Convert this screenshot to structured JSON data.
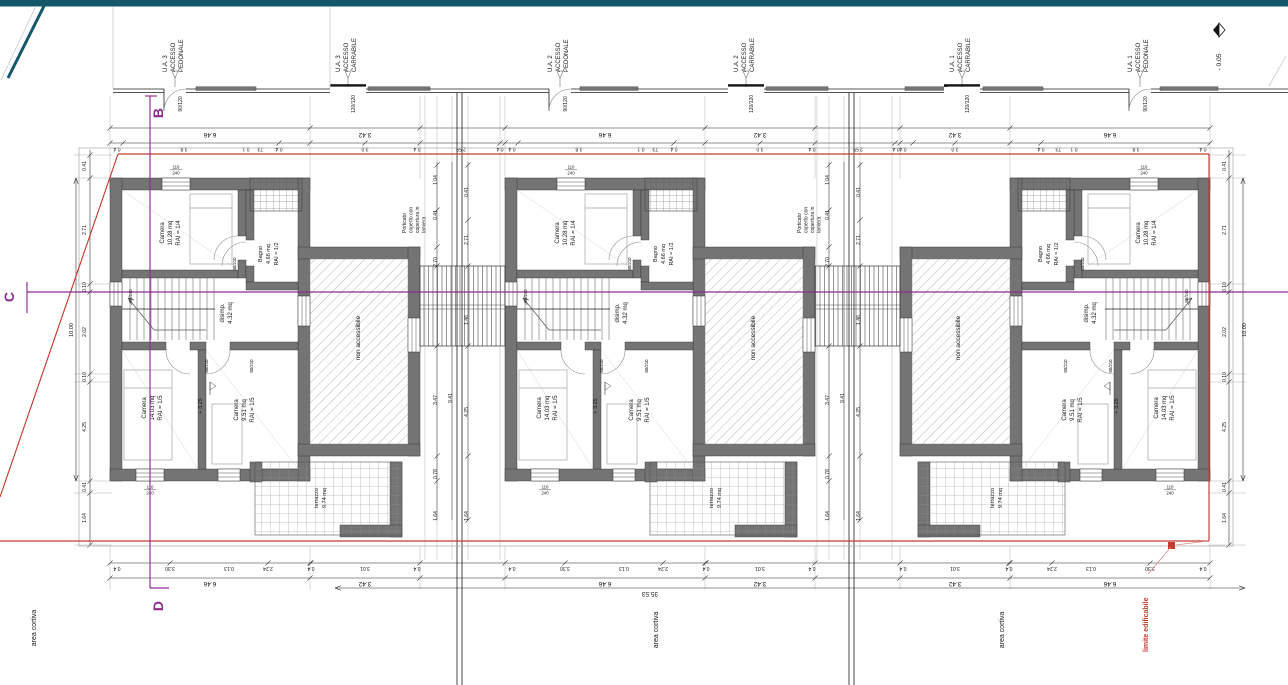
{
  "drawing": {
    "rooms": {
      "camera1": {
        "name": "Camera",
        "area": "10.28 mq",
        "rai": "RAI = 1/4"
      },
      "bagno": {
        "name": "Bagno",
        "area": "4.66 mq",
        "rai": "RAI = 1/2"
      },
      "disimp": {
        "name": "disimp.",
        "area": "4.32 mq"
      },
      "camera2": {
        "name": "Camera",
        "area": "14.03 mq",
        "rai": "RAI = 1/5"
      },
      "camera3": {
        "name": "Camera",
        "area": "9.51 mq",
        "rai": "RAI = 1/5"
      },
      "terrace": {
        "name": "non accessibile"
      },
      "terrazzo": {
        "name": "terrazzo",
        "area": "9.74 mq"
      },
      "level": "+ 3.25"
    },
    "units": [
      {
        "id": "U.A. 3",
        "x": 110,
        "mirrored": false
      },
      {
        "id": "U.A. 2",
        "x": 505,
        "mirrored": false
      },
      {
        "id": "U.A. 1",
        "x": 900,
        "mirrored": true
      }
    ],
    "access_points": [
      {
        "unit": "U.A. 3",
        "line2": "ACCESSO",
        "line3": "PEDONALE",
        "gate": "90/120",
        "x": 175,
        "type": "pedonale"
      },
      {
        "unit": "U.A. 3",
        "line2": "ACCESSO",
        "line3": "CARRABILE",
        "gate": "120/120",
        "x": 348,
        "type": "carrabile"
      },
      {
        "unit": "U.A. 2",
        "line2": "ACCESSO",
        "line3": "PEDONALE",
        "gate": "90/120",
        "x": 560,
        "type": "pedonale"
      },
      {
        "unit": "U.A. 2",
        "line2": "ACCESSO",
        "line3": "CARRABILE",
        "gate": "120/120",
        "x": 746,
        "type": "carrabile"
      },
      {
        "unit": "U.A. 1",
        "line2": "ACCESSO",
        "line3": "CARRABILE",
        "gate": "120/120",
        "x": 962,
        "type": "carrabile"
      },
      {
        "unit": "U.A. 1",
        "line2": "ACCESSO",
        "line3": "PEDONALE",
        "gate": "90/120",
        "x": 1140,
        "type": "pedonale"
      }
    ],
    "porticato_note": [
      "Porticato",
      "coperto con",
      "copertura in",
      "lamiera"
    ],
    "porticato_x": [
      420,
      815
    ],
    "section_markers": {
      "top": "B",
      "left": "C",
      "bottom": "D"
    },
    "elevation_marker": "- 0.05",
    "area_labels": [
      "area cortiva",
      "area cortiva",
      "area cortiva"
    ],
    "boundary_label": "limite edificabile",
    "overall_width": "35.53",
    "window_labels": {
      "top_num": "110",
      "top_den": "240",
      "side": "80/240",
      "door": "80/210"
    },
    "dim_labels": [
      [
        "6.46",
        210,
        133,
        180,
        6.5
      ],
      [
        "3.42",
        365,
        133,
        180,
        6.5
      ],
      [
        "6.46",
        605,
        133,
        180,
        6.5
      ],
      [
        "3.42",
        760,
        133,
        180,
        6.5
      ],
      [
        "3.42",
        955,
        133,
        180,
        6.5
      ],
      [
        "6.46",
        1110,
        133,
        180,
        6.5
      ],
      [
        "6.46",
        210,
        582,
        180,
        6.5
      ],
      [
        "3.42",
        365,
        582,
        180,
        6.5
      ],
      [
        "6.46",
        605,
        582,
        180,
        6.5
      ],
      [
        "3.42",
        760,
        582,
        180,
        6.5
      ],
      [
        "3.42",
        955,
        582,
        180,
        6.5
      ],
      [
        "6.46",
        1110,
        582,
        180,
        6.5
      ],
      [
        "0.4",
        117,
        147.5,
        180,
        5
      ],
      [
        "3.8",
        184,
        147.5,
        180,
        5
      ],
      [
        "0.1",
        246,
        147.5,
        180,
        5
      ],
      [
        ".73",
        261,
        147.5,
        180,
        5
      ],
      [
        "0.4",
        279,
        147.5,
        180,
        5
      ],
      [
        "3.0",
        365,
        147.5,
        180,
        5
      ],
      [
        "0.4",
        417,
        147.5,
        180,
        5
      ],
      [
        "2.55",
        461,
        147.5,
        180,
        5
      ],
      [
        "0.4",
        500,
        147.5,
        180,
        5
      ],
      [
        "0.4",
        512,
        147.5,
        180,
        5
      ],
      [
        "3.8",
        579,
        147.5,
        180,
        5
      ],
      [
        "0.1",
        641,
        147.5,
        180,
        5
      ],
      [
        ".73",
        656,
        147.5,
        180,
        5
      ],
      [
        "0.4",
        674,
        147.5,
        180,
        5
      ],
      [
        "3.0",
        760,
        147.5,
        180,
        5
      ],
      [
        "0.4",
        812,
        147.5,
        180,
        5
      ],
      [
        "2.55",
        858,
        147.5,
        180,
        5
      ],
      [
        "0.4",
        896,
        147.5,
        180,
        5
      ],
      [
        "0.4",
        1203,
        147.5,
        180,
        5
      ],
      [
        "3.8",
        1136,
        147.5,
        180,
        5
      ],
      [
        "0.1",
        1074,
        147.5,
        180,
        5
      ],
      [
        ".73",
        1059,
        147.5,
        180,
        5
      ],
      [
        "0.4",
        1041,
        147.5,
        180,
        5
      ],
      [
        "3.0",
        955,
        147.5,
        180,
        5
      ],
      [
        "0.4",
        903,
        147.5,
        180,
        5
      ],
      [
        "0.4",
        117,
        567,
        180,
        5
      ],
      [
        "3.30",
        170,
        567,
        180,
        5
      ],
      [
        "0.13",
        229,
        567,
        180,
        5
      ],
      [
        "2.24",
        268,
        567,
        180,
        5
      ],
      [
        "0.4",
        311,
        567,
        180,
        5
      ],
      [
        "3.01",
        365,
        567,
        180,
        5
      ],
      [
        "0.4",
        417,
        567,
        180,
        5
      ],
      [
        "0.4",
        512,
        567,
        180,
        5
      ],
      [
        "3.30",
        565,
        567,
        180,
        5
      ],
      [
        "0.13",
        624,
        567,
        180,
        5
      ],
      [
        "2.24",
        663,
        567,
        180,
        5
      ],
      [
        "0.4",
        706,
        567,
        180,
        5
      ],
      [
        "3.01",
        760,
        567,
        180,
        5
      ],
      [
        "0.4",
        812,
        567,
        180,
        5
      ],
      [
        "0.4",
        1203,
        567,
        180,
        5
      ],
      [
        "3.30",
        1150,
        567,
        180,
        5
      ],
      [
        "0.13",
        1091,
        567,
        180,
        5
      ],
      [
        "2.24",
        1052,
        567,
        180,
        5
      ],
      [
        "0.4",
        1009,
        567,
        180,
        5
      ],
      [
        "3.01",
        955,
        567,
        180,
        5
      ],
      [
        "0.4",
        903,
        567,
        180,
        5
      ],
      [
        "0.41",
        86,
        166,
        -90,
        5
      ],
      [
        "2.71",
        86,
        230,
        -90,
        5
      ],
      [
        "0.10",
        86,
        287,
        -90,
        5
      ],
      [
        "2.02",
        86,
        332,
        -90,
        5
      ],
      [
        "0.10",
        86,
        377,
        -90,
        5
      ],
      [
        "4.25",
        86,
        427,
        -90,
        5
      ],
      [
        "0.41",
        86,
        487,
        -90,
        5
      ],
      [
        "1.64",
        86,
        518,
        -90,
        5
      ],
      [
        "10.00",
        73,
        330,
        -90,
        5.5
      ],
      [
        "0.41",
        1226,
        166,
        -90,
        5
      ],
      [
        "2.71",
        1226,
        230,
        -90,
        5
      ],
      [
        "0.10",
        1226,
        287,
        -90,
        5
      ],
      [
        "2.02",
        1226,
        332,
        -90,
        5
      ],
      [
        "0.10",
        1226,
        377,
        -90,
        5
      ],
      [
        "4.25",
        1226,
        427,
        -90,
        5
      ],
      [
        "0.41",
        1226,
        487,
        -90,
        5
      ],
      [
        "1.64",
        1226,
        518,
        -90,
        5
      ],
      [
        "10.00",
        1246,
        330,
        -90,
        5.5
      ],
      [
        "1.04",
        437,
        180,
        -90,
        5
      ],
      [
        "0.41",
        437,
        215,
        -90,
        5
      ],
      [
        "2.70",
        437,
        262,
        -90,
        5
      ],
      [
        "3.47",
        437,
        400,
        -90,
        5
      ],
      [
        "0.78",
        437,
        474,
        -90,
        5
      ],
      [
        "1.64",
        437,
        516,
        -90,
        5
      ],
      [
        "9.41",
        452,
        398,
        -90,
        5
      ],
      [
        "0.41",
        468,
        192,
        -90,
        5
      ],
      [
        "2.71",
        468,
        240,
        -90,
        5
      ],
      [
        "1.46",
        468,
        320,
        -90,
        5
      ],
      [
        "4.25",
        468,
        412,
        -90,
        5
      ],
      [
        "1.64",
        468,
        516,
        -90,
        5
      ],
      [
        "1.04",
        829,
        180,
        -90,
        5
      ],
      [
        "0.41",
        829,
        215,
        -90,
        5
      ],
      [
        "2.70",
        829,
        262,
        -90,
        5
      ],
      [
        "3.47",
        829,
        400,
        -90,
        5
      ],
      [
        "0.78",
        829,
        474,
        -90,
        5
      ],
      [
        "1.64",
        829,
        516,
        -90,
        5
      ],
      [
        "9.41",
        844,
        398,
        -90,
        5
      ],
      [
        "0.41",
        860,
        192,
        -90,
        5
      ],
      [
        "2.71",
        860,
        240,
        -90,
        5
      ],
      [
        "1.46",
        860,
        320,
        -90,
        5
      ],
      [
        "4.25",
        860,
        412,
        -90,
        5
      ],
      [
        "1.64",
        860,
        516,
        -90,
        5
      ]
    ]
  }
}
